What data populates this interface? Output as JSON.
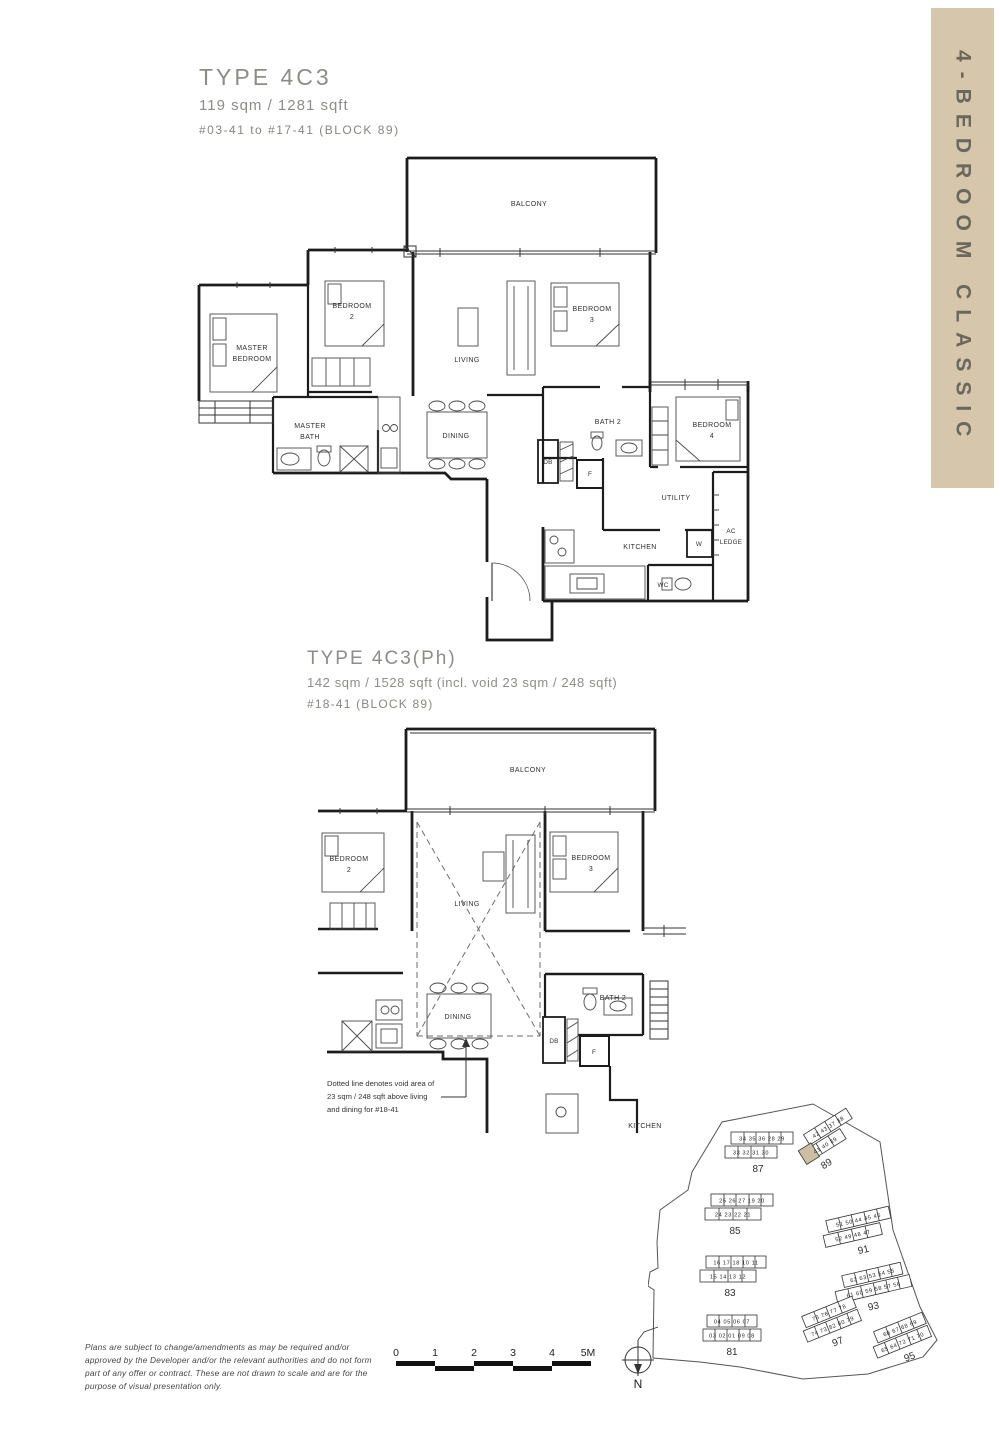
{
  "sidebar": {
    "label": "4-BEDROOM CLASSIC",
    "bg": "#d5c6ac",
    "fg": "#6b675a"
  },
  "plan1": {
    "title": "TYPE 4C3",
    "area": "119 sqm / 1281 sqft",
    "units": "#03-41 to #17-41 (BLOCK 89)",
    "rooms": {
      "balcony": "BALCONY",
      "master_bedroom": [
        "MASTER",
        "BEDROOM"
      ],
      "bedroom2": [
        "BEDROOM",
        "2"
      ],
      "living": "LIVING",
      "bedroom3": [
        "BEDROOM",
        "3"
      ],
      "master_bath": [
        "MASTER",
        "BATH"
      ],
      "dining": "DINING",
      "bath2": "BATH 2",
      "db": "DB",
      "f": "F",
      "bedroom4": [
        "BEDROOM",
        "4"
      ],
      "utility": "UTILITY",
      "ac_ledge": [
        "AC",
        "LEDGE"
      ],
      "kitchen": "KITCHEN",
      "w": "W",
      "wc": "WC"
    }
  },
  "plan2": {
    "title": "TYPE 4C3(Ph)",
    "area": "142 sqm / 1528 sqft (incl. void 23 sqm / 248 sqft)",
    "units": "#18-41 (BLOCK 89)",
    "rooms": {
      "balcony": "BALCONY",
      "bedroom2": [
        "BEDROOM",
        "2"
      ],
      "living": "LIVING",
      "bedroom3": [
        "BEDROOM",
        "3"
      ],
      "dining": "DINING",
      "bath2": "BATH 2",
      "db": "DB",
      "f": "F",
      "kitchen": "KITCHEN"
    },
    "note": [
      "Dotted line denotes void area of",
      "23 sqm / 248 sqft above living",
      "and dining for #18-41"
    ]
  },
  "site_plan": {
    "highlight_unit": "41",
    "highlight_color": "#cdbfa4",
    "blocks": [
      {
        "number": "87",
        "row1": "34 35 36 28 29",
        "row2": "33 32 31 30"
      },
      {
        "number": "89",
        "row1": "42 43 37 38",
        "row2": "41 40 39"
      },
      {
        "number": "85",
        "row1": "25 26 27 19 20",
        "row2": "24 23 22 21"
      },
      {
        "number": "91",
        "row1": "51 50 44 45 46",
        "row2": "52 49 48 47"
      },
      {
        "number": "83",
        "row1": "16 17 18 10 11",
        "row2": "15 14 13 12"
      },
      {
        "number": "93",
        "row1": "62 63 53 54 55",
        "row2": "61 60 59 58 57 56"
      },
      {
        "number": "81",
        "row1": "04 05 06 07",
        "row2": "03 02 01 09 08"
      },
      {
        "number": "97",
        "row1": "75 76 77 78",
        "row2": "74 73 82 80 79"
      },
      {
        "number": "95",
        "row1": "66 67 68 69",
        "row2": "65 64 72 71 70"
      }
    ]
  },
  "scale_bar": {
    "labels": [
      "0",
      "1",
      "2",
      "3",
      "4",
      "5M"
    ]
  },
  "compass": {
    "label": "N"
  },
  "disclaimer": {
    "lines": [
      "Plans are subject to change/amendments as may be required and/or",
      "approved by the Developer and/or the relevant authorities and do not form",
      "part of any offer or contract. These are not drawn to scale and are for the",
      "purpose of visual presentation only."
    ]
  }
}
